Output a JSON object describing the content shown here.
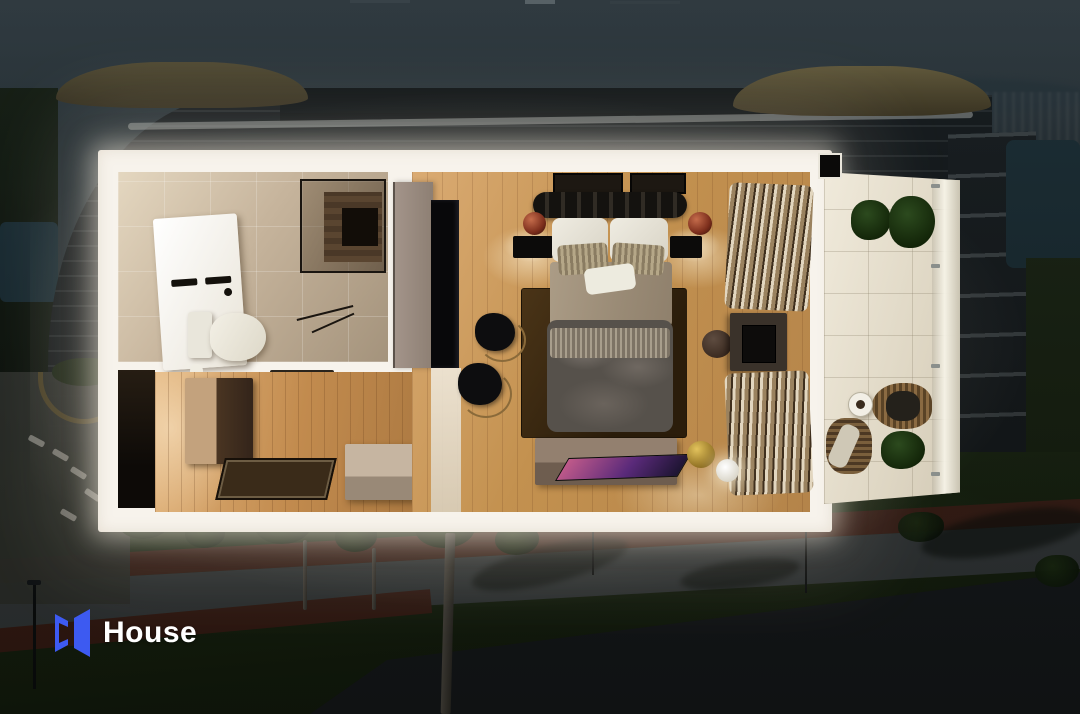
{
  "brand": {
    "name": "House",
    "logo_blue": "#3D5AF1",
    "text_color": "#FFFFFF"
  },
  "colors": {
    "frame_white": "#F7F3EC",
    "wood_floor": "#C3914F",
    "bathroom_tile": "#C6B49C",
    "balcony_floor": "#E6DFCF",
    "dusk_background": "#2F3A3F",
    "path_red": "#542419",
    "lawn_green": "#1A260E"
  },
  "floor_plan": {
    "type": "3d-top-down-apartment-render",
    "rooms": [
      {
        "id": "bathroom",
        "position": "top-left",
        "features": [
          "white vanity with sink",
          "toilet",
          "glass shower with wood wall",
          "beige stone tiles",
          "floor mat track"
        ]
      },
      {
        "id": "entry-hall",
        "position": "bottom-left",
        "features": [
          "dark entry doorway",
          "wood console cabinet",
          "dark doormat",
          "storage bench",
          "wood plank floor",
          "green tray",
          "remote"
        ]
      },
      {
        "id": "bedroom",
        "position": "center",
        "features": [
          "double bed with dark striped headboard",
          "white pillows",
          "striped cushions",
          "beige blanket",
          "grey duvet",
          "dark brown rug",
          "two black nightstands",
          "two copper lamps",
          "two framed artworks",
          "taupe sliding door",
          "black wardrobe",
          "two black lounge chairs",
          "round stool",
          "tv cabinet on right wall",
          "striped drape curtains",
          "media console with flat tv",
          "gold bowl",
          "white sphere lamp"
        ]
      },
      {
        "id": "balcony",
        "position": "right",
        "features": [
          "cream tile floor",
          "glass railing with posts",
          "two potted plants",
          "rattan armchair with dark cushion",
          "round side table with coffee",
          "rattan lounge chair with throw",
          "floor plant",
          "ceiling spotlight"
        ]
      }
    ]
  },
  "background": {
    "description": "darkened dusk aerial photo of a curved residential apartment building with gold rooftop canopies, lake water, lawns, palm trees, red jogging path, grey walkway and pool deck with loungers"
  }
}
